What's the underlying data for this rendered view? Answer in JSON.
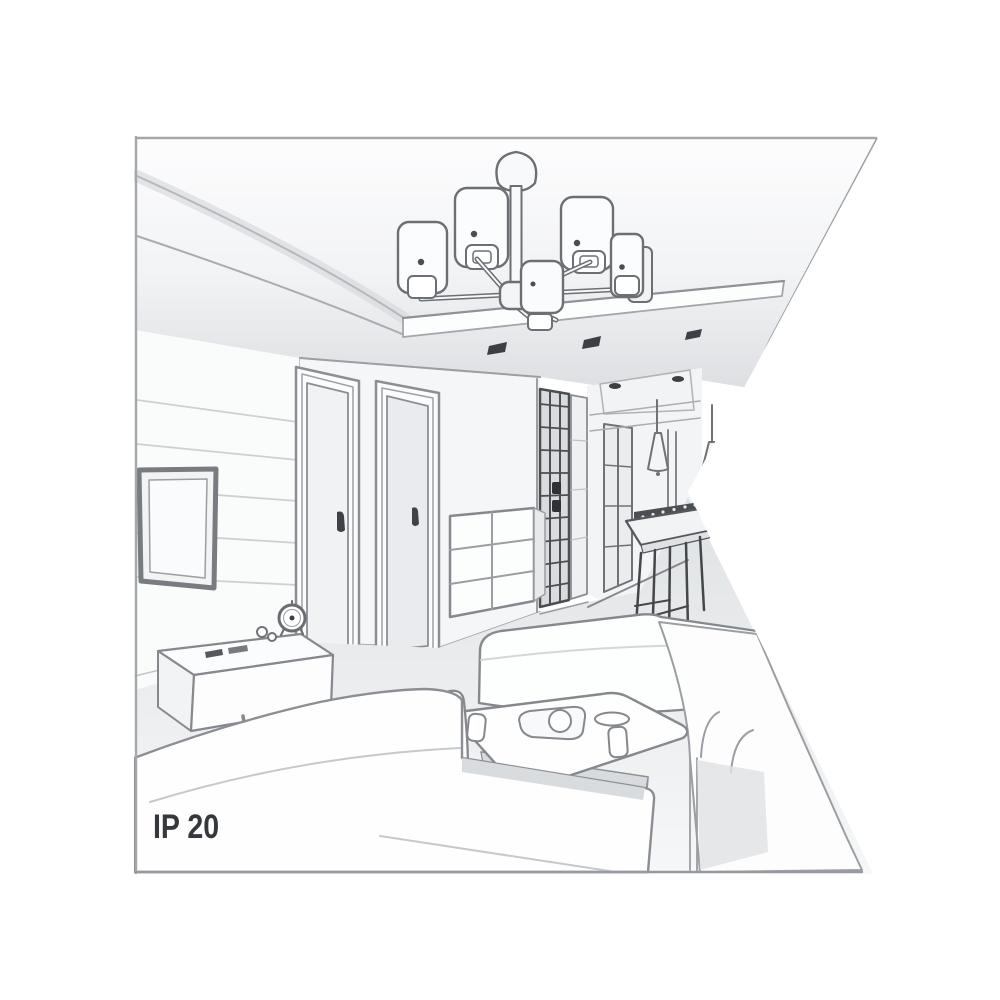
{
  "illustration": {
    "ip_rating_label": "IP 20",
    "description": "grayscale perspective line sketch of a living room interior with a six-shade ceiling chandelier, clipped by a white triangular notch on the right",
    "colors": {
      "background": "#ffffff",
      "line_main": "#85888d",
      "line_strong": "#6c6f74",
      "line_faint": "#c3c6c9",
      "dark_detail": "#3c3f43",
      "label_text": "#35383c",
      "ceiling_shade": "#dddfe2",
      "floor_shade": "#e4e6e8"
    },
    "objects": [
      "six-shade-ceiling-chandelier",
      "tray-ceiling-with-recessed-downlights",
      "wall-mounted-tv",
      "tv-sideboard-with-clock-and-remotes",
      "two-interior-doors",
      "chest-of-drawers",
      "dark-glass-partition",
      "hallway-window",
      "two-cone-pendant-lights",
      "dining-table-with-dark-chairs",
      "corner-sofa",
      "chaise-seat",
      "right-sofa",
      "coffee-table-with-tray-teapot-plate-cups"
    ]
  }
}
